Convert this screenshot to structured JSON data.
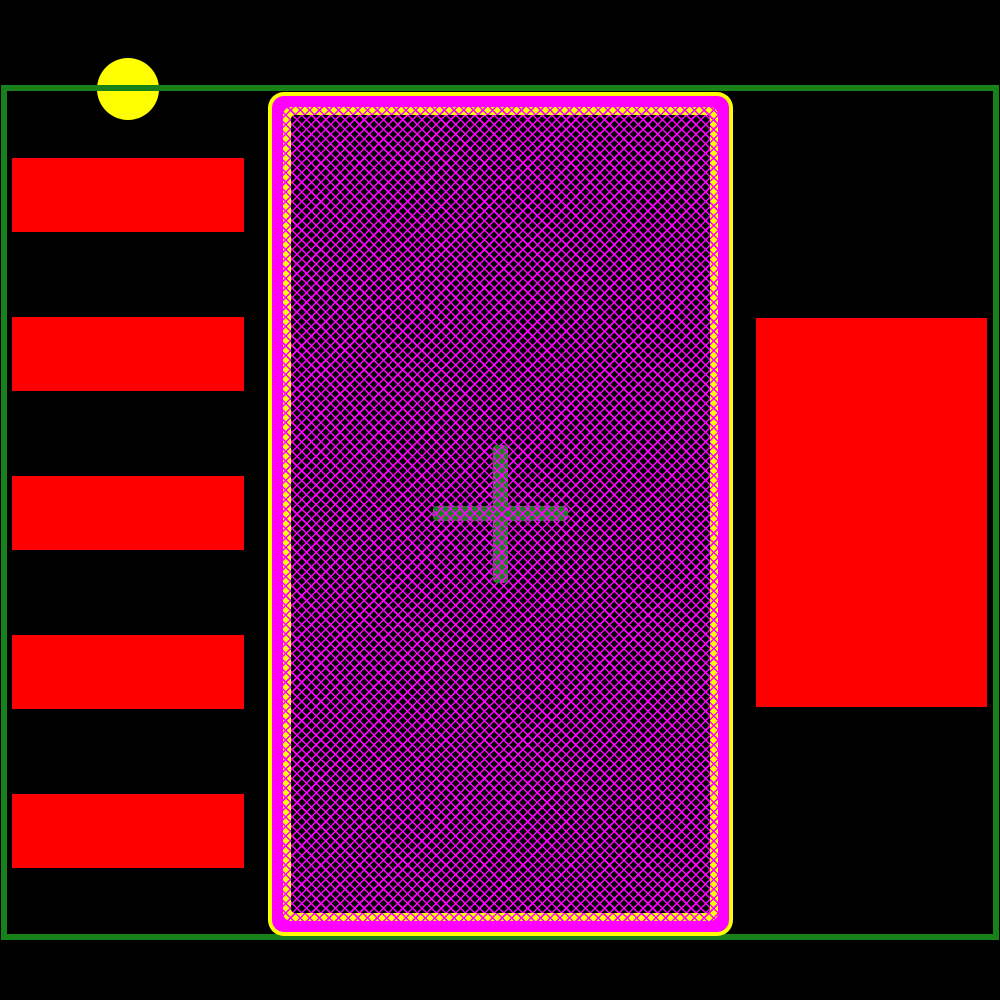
{
  "canvas": {
    "width": 1000,
    "height": 1000
  },
  "colors": {
    "black": "#000000",
    "red": "#ff0000",
    "yellow": "#ffff00",
    "magenta": "#ff00ff",
    "green": "#198119",
    "cross_green": "#1f8021"
  },
  "board_outline": {
    "x": 1,
    "y": 85,
    "w": 998,
    "h": 855,
    "stroke_width": 6
  },
  "pin1_marker": {
    "cx": 128,
    "cy": 89,
    "r": 31
  },
  "left_pads": [
    {
      "x": 12,
      "y": 158,
      "w": 232,
      "h": 74
    },
    {
      "x": 12,
      "y": 317,
      "w": 232,
      "h": 74
    },
    {
      "x": 12,
      "y": 476,
      "w": 232,
      "h": 74
    },
    {
      "x": 12,
      "y": 635,
      "w": 232,
      "h": 74
    },
    {
      "x": 12,
      "y": 794,
      "w": 232,
      "h": 74
    }
  ],
  "right_pad": {
    "x": 756,
    "y": 318,
    "w": 231,
    "h": 389
  },
  "thermal_pad": {
    "outer": {
      "x": 268,
      "y": 92,
      "w": 465,
      "h": 844
    },
    "magenta": {
      "x": 272,
      "y": 96,
      "w": 457,
      "h": 836
    },
    "ring": {
      "x": 283,
      "y": 107,
      "w": 435,
      "h": 814
    },
    "hatch": {
      "x": 291,
      "y": 115,
      "w": 419,
      "h": 798
    }
  },
  "origin_cross": {
    "h_bar": {
      "x": 433,
      "y": 506,
      "w": 135,
      "h": 15
    },
    "v_bar": {
      "x": 493,
      "y": 445,
      "w": 15,
      "h": 138
    }
  }
}
